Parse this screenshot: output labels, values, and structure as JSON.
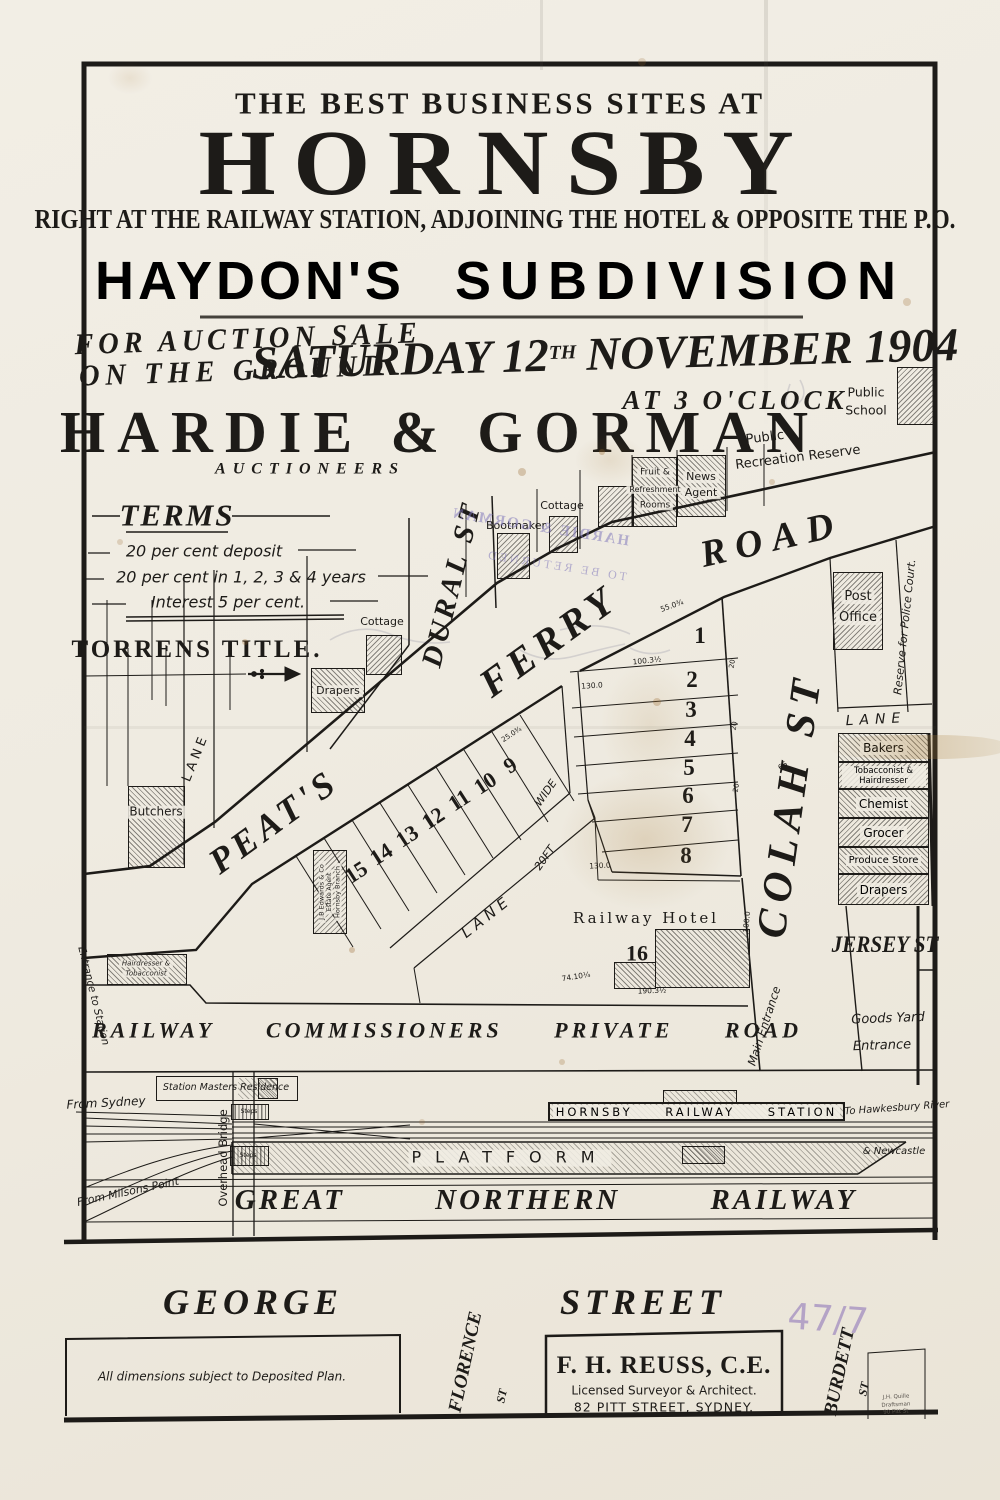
{
  "colors": {
    "paper": "#efebe1",
    "ink": "#1d1b18",
    "stamp_purple": "#8279bc",
    "pencil": "#b4a3c6"
  },
  "header": {
    "tagline": "THE BEST BUSINESS SITES AT",
    "title": "HORNSBY",
    "subtitle": "RIGHT AT THE RAILWAY STATION, ADJOINING THE HOTEL & OPPOSITE THE P.O.",
    "subdivision_1": "HAYDON'S",
    "subdivision_2": "SUBDIVISION"
  },
  "auction": {
    "sale_line1": "FOR AUCTION SALE",
    "sale_line2": "ON THE GROUND",
    "date_pre": "SATURDAY 12",
    "date_sup": "TH",
    "date_post": "NOVEMBER 1904",
    "time": "AT 3 O'CLOCK",
    "auctioneer": "HARDIE & GORMAN",
    "auctioneer_role": "AUCTIONEERS"
  },
  "terms": {
    "heading": "TERMS",
    "line1": "20 per cent deposit",
    "line2": "20 per cent in 1, 2, 3 & 4 years",
    "line3": "Interest 5 per cent.",
    "tenure": "TORRENS TITLE."
  },
  "map": {
    "streets": {
      "dural": "DURAL ST",
      "ferry": "FERRY",
      "road": "ROAD",
      "peats": "PEAT'S",
      "colah": "COLAH ST",
      "jersey": "JERSEY ST",
      "lane_w": "LANE",
      "lane_e": "LANE",
      "lane_c": "LANE",
      "lane_20ft": "20FT",
      "lane_wide": "WIDE"
    },
    "areas": {
      "recreation_1": "Public",
      "recreation_2": "Recreation Reserve",
      "school_1": "Public",
      "school_2": "School",
      "police_reserve": "Reserve for Police Court.",
      "goods_1": "Goods Yard",
      "goods_2": "Entrance",
      "main_entrance": "Main Entrance",
      "entrance_station": "Entrance to Station"
    },
    "buildings": {
      "bootmaker": "Bootmaker",
      "cottage_a": "Cottage",
      "cottage_b": "Cottage",
      "fruit_1": "Fruit &",
      "fruit_2": "Refreshment",
      "fruit_3": "Rooms",
      "news_1": "News",
      "news_2": "Agent",
      "post_1": "Post",
      "post_2": "Office",
      "drapers_a": "Drapers",
      "butchers": "Butchers",
      "hair_1": "Hairdresser &",
      "hair_2": "Tobacconist",
      "edwards_1": "J.B Edwards & Co",
      "edwards_2": "Estate Agent",
      "edwards_3": "Hornsby Branch",
      "hotel": "Railway Hotel",
      "station_masters": "Station Masters Residence",
      "steps": "Steps"
    },
    "shops_right": [
      "Bakers",
      "Tobacconist & Hairdresser",
      "Chemist",
      "Grocer",
      "Produce Store",
      "Drapers"
    ],
    "lots_a": [
      "1",
      "2",
      "3",
      "4",
      "5",
      "6",
      "7",
      "8"
    ],
    "lots_b": [
      "9",
      "10",
      "11",
      "12",
      "13",
      "14",
      "15"
    ],
    "lot_16": "16",
    "dims": [
      "55.0¾",
      "100.3½",
      "130.0",
      "130.0",
      "190.3½",
      "74.10¼",
      "100.0",
      "66",
      "20",
      "20",
      "20",
      "25.0¾"
    ],
    "railway": {
      "private_road": "RAILWAY COMMISSIONERS PRIVATE ROAD",
      "station_bar": "HORNSBY RAILWAY STATION",
      "platform": "PLATFORM",
      "great_northern": "GREAT NORTHERN RAILWAY",
      "to_hawkesbury": "To Hawkesbury River",
      "newcastle": "& Newcastle",
      "from_sydney": "From Sydney",
      "from_milsons": "From Milsons Point",
      "overhead_bridge": "Overhead Bridge"
    }
  },
  "stamp": {
    "line1": "HARDIE & GORMAN",
    "line2": "TO BE RETURNED"
  },
  "pencil": {
    "mark": "47/7"
  },
  "footer": {
    "george": "GEORGE",
    "street": "STREET",
    "dims_note": "All dimensions subject to Deposited Plan.",
    "surveyor_name": "F. H. REUSS, C.E.",
    "surveyor_role": "Licensed Surveyor & Architect.",
    "surveyor_addr": "82 PITT STREET, SYDNEY.",
    "florence": "FLORENCE",
    "florence_st": "ST",
    "burdett": "BURDETT",
    "burdett_st": "ST",
    "draftsman_1": "J.H. Quille",
    "draftsman_2": "Draftsman",
    "draftsman_3": "90 Pitt St"
  }
}
